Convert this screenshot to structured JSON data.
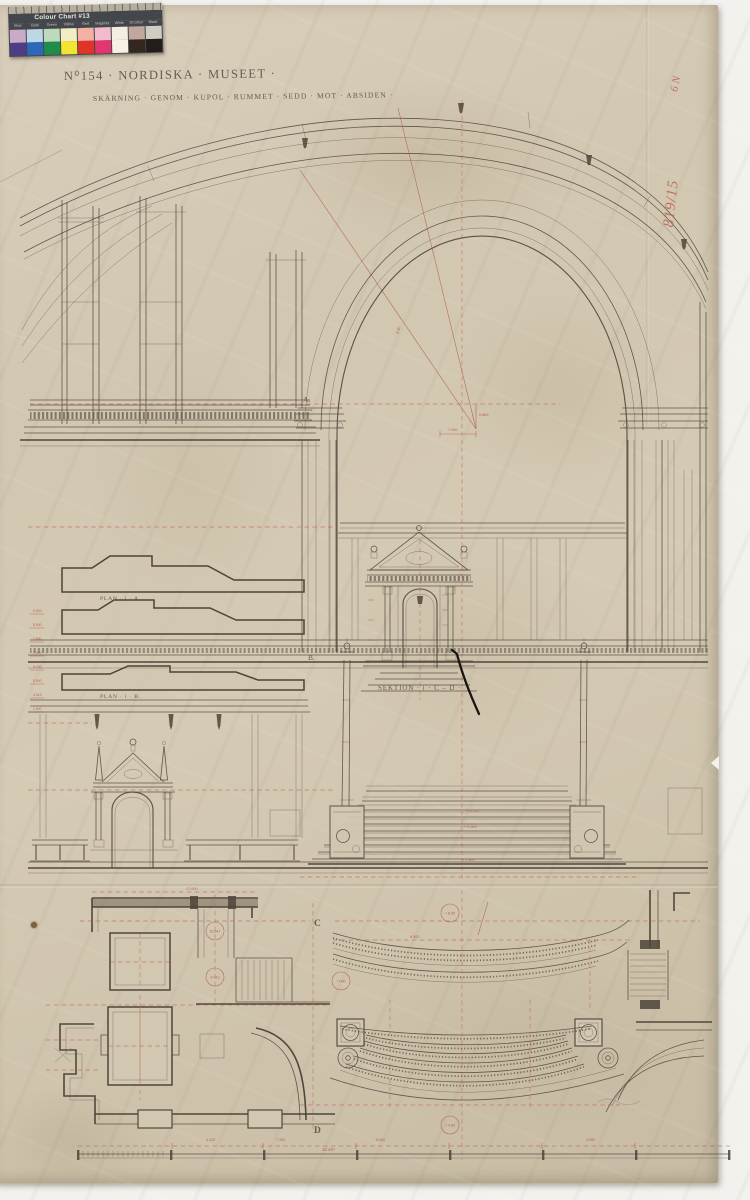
{
  "photo": {
    "backdrop": "#f2f1ee",
    "paper": "#d2c7b1",
    "ink": "#4e443a",
    "dimension_red": "#b3544a"
  },
  "color_chart": {
    "title": "Colour Chart #13",
    "column_labels": [
      "Blue",
      "Cyan",
      "Green",
      "Yellow",
      "Red",
      "Magenta",
      "White",
      "3/Colour",
      "Black"
    ],
    "top_row": [
      "#c9aac8",
      "#bdd7e6",
      "#bedabe",
      "#f2eec2",
      "#f2b2a2",
      "#f2bacd",
      "#f3eee1",
      "#c2a6a0",
      "#cfccc4"
    ],
    "bottom_row": [
      "#4d3d85",
      "#2c67b9",
      "#1f8d49",
      "#f3e430",
      "#e13328",
      "#e1366f",
      "#f6f1e3",
      "#33271f",
      "#231d19"
    ]
  },
  "handwriting": {
    "line1": "819/15",
    "line2": "6 N"
  },
  "titles": {
    "main": "N⁰154 · NORDISKA · MUSEET ·",
    "sub": "SKÄRNING · GENOM · KUPOL · RUMMET · SEDD · MOT · ABSIDEN ·"
  },
  "labels": {
    "mark_a": "A.",
    "mark_b": "B.",
    "plan_a": "PLAN · i · A.",
    "plan_b": "PLAN · i · B.",
    "sektion_cd": "SEKTION · i · C – D ·",
    "mark_c": "C",
    "mark_d": "D"
  },
  "dims": {
    "radial": "8.80",
    "rise": "0.889",
    "half_span": "7.000",
    "stair_top": "+ 5.150",
    "stair_mid": "+ 5.500",
    "stair_base": "+ 2.800",
    "plan_top_width": "17.000",
    "plan_depth": "8.500",
    "level_c1": "10.547",
    "level_c2": "4.013",
    "level_c3": "7.000",
    "level_c4": "+ 8.50",
    "level_c5": "+ 4.89",
    "scale_a": "4.125",
    "scale_b": "7.283",
    "scale_c": "8.000",
    "scale_d": "2.650",
    "scale_total": "16.43ᵐ",
    "left_levels": [
      "9.600",
      "8.500",
      "7.600",
      "7.000",
      "6.200",
      "5.500",
      "4.013",
      "2.800"
    ]
  }
}
